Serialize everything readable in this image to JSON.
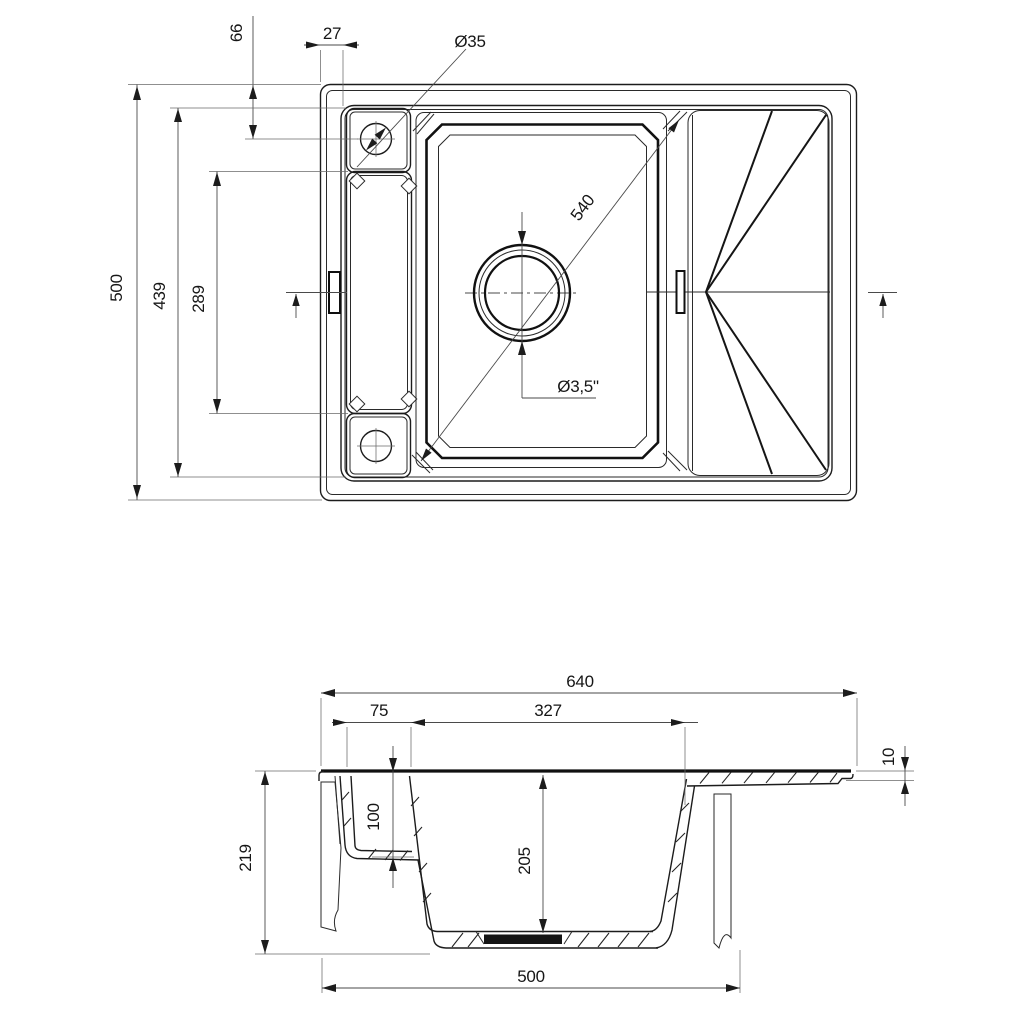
{
  "drawing": {
    "background_color": "#ffffff",
    "line_color": "#1c1c1c",
    "views": {
      "top_view_position": "upper",
      "section_view_position": "lower"
    },
    "dims": {
      "tv_overall_depth": "500",
      "tv_inner_depth": "439",
      "tv_tray_length": "289",
      "tv_hole_offset": "66",
      "tv_edge_margin": "27",
      "tv_faucet_hole_dia": "Ø35",
      "tv_bowl_diagonal": "540",
      "tv_drain_dia": "Ø3,5\"",
      "sv_overall_width": "640",
      "sv_tray_width": "75",
      "sv_bowl_opening": "327",
      "sv_board_thickness": "10",
      "sv_overall_height": "219",
      "sv_tray_depth": "100",
      "sv_bowl_depth": "205",
      "sv_cutout_width": "500"
    }
  }
}
